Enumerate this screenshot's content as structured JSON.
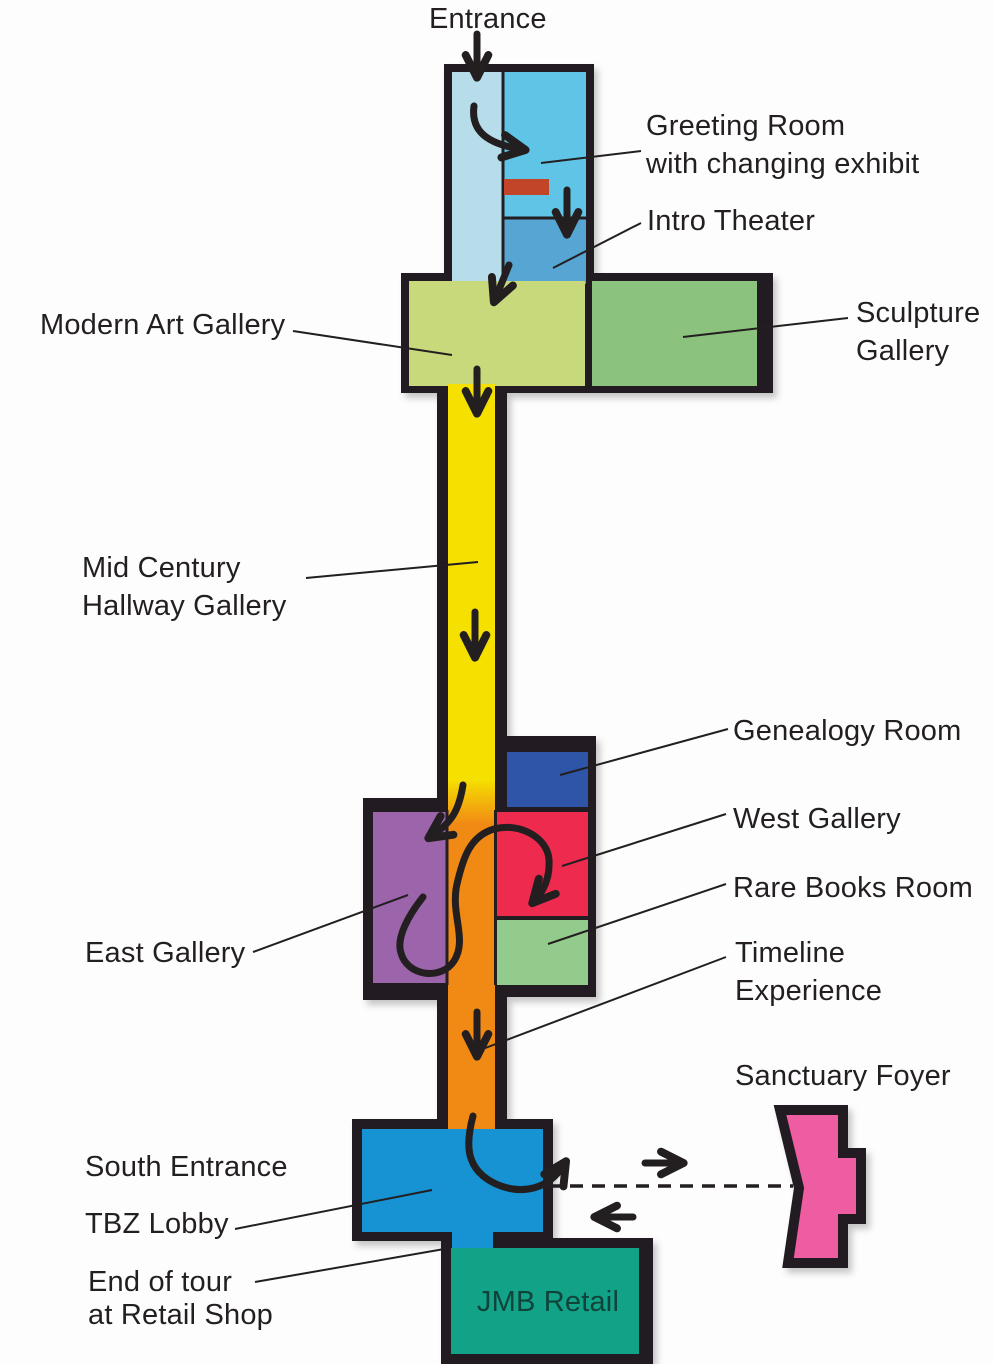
{
  "labels": {
    "entrance": [
      "Entrance"
    ],
    "greeting": [
      "Greeting Room",
      "with changing exhibit"
    ],
    "intro": [
      "Intro Theater"
    ],
    "modern": [
      "Modern Art Gallery"
    ],
    "sculpture": [
      "Sculpture",
      "Gallery"
    ],
    "midcentury": [
      "Mid Century",
      "Hallway Gallery"
    ],
    "genealogy": [
      "Genealogy Room"
    ],
    "west": [
      "West Gallery"
    ],
    "rare": [
      "Rare Books Room"
    ],
    "east": [
      "East Gallery"
    ],
    "timeline": [
      "Timeline",
      "Experience"
    ],
    "sanctuary": [
      "Sanctuary Foyer"
    ],
    "south_entrance": [
      "South Entrance"
    ],
    "tbz_lobby": [
      "TBZ Lobby"
    ],
    "end_of_tour": [
      "End of tour",
      "at Retail Shop"
    ],
    "retail": [
      "JMB Retail"
    ]
  },
  "colors": {
    "outline": "#231f20",
    "background": "#fdfdfd",
    "label_text": "#231f20",
    "entrance_corridor": "#b7dcea",
    "greeting": "#60c4e6",
    "intro_theater": "#57a5d2",
    "modern": "#c8d97c",
    "sculpture": "#8bc27e",
    "hallway": "#f5e000",
    "timeline": "#f18a15",
    "genealogy": "#2f55a8",
    "west": "#ee2b4e",
    "east": "#9b64ab",
    "rare": "#92cb8b",
    "lobby": "#1792d3",
    "retail": "#12a288",
    "retail_text": "#10433a",
    "sanctuary": "#ee5ba1",
    "exhibit_desk": "#c2452a"
  }
}
